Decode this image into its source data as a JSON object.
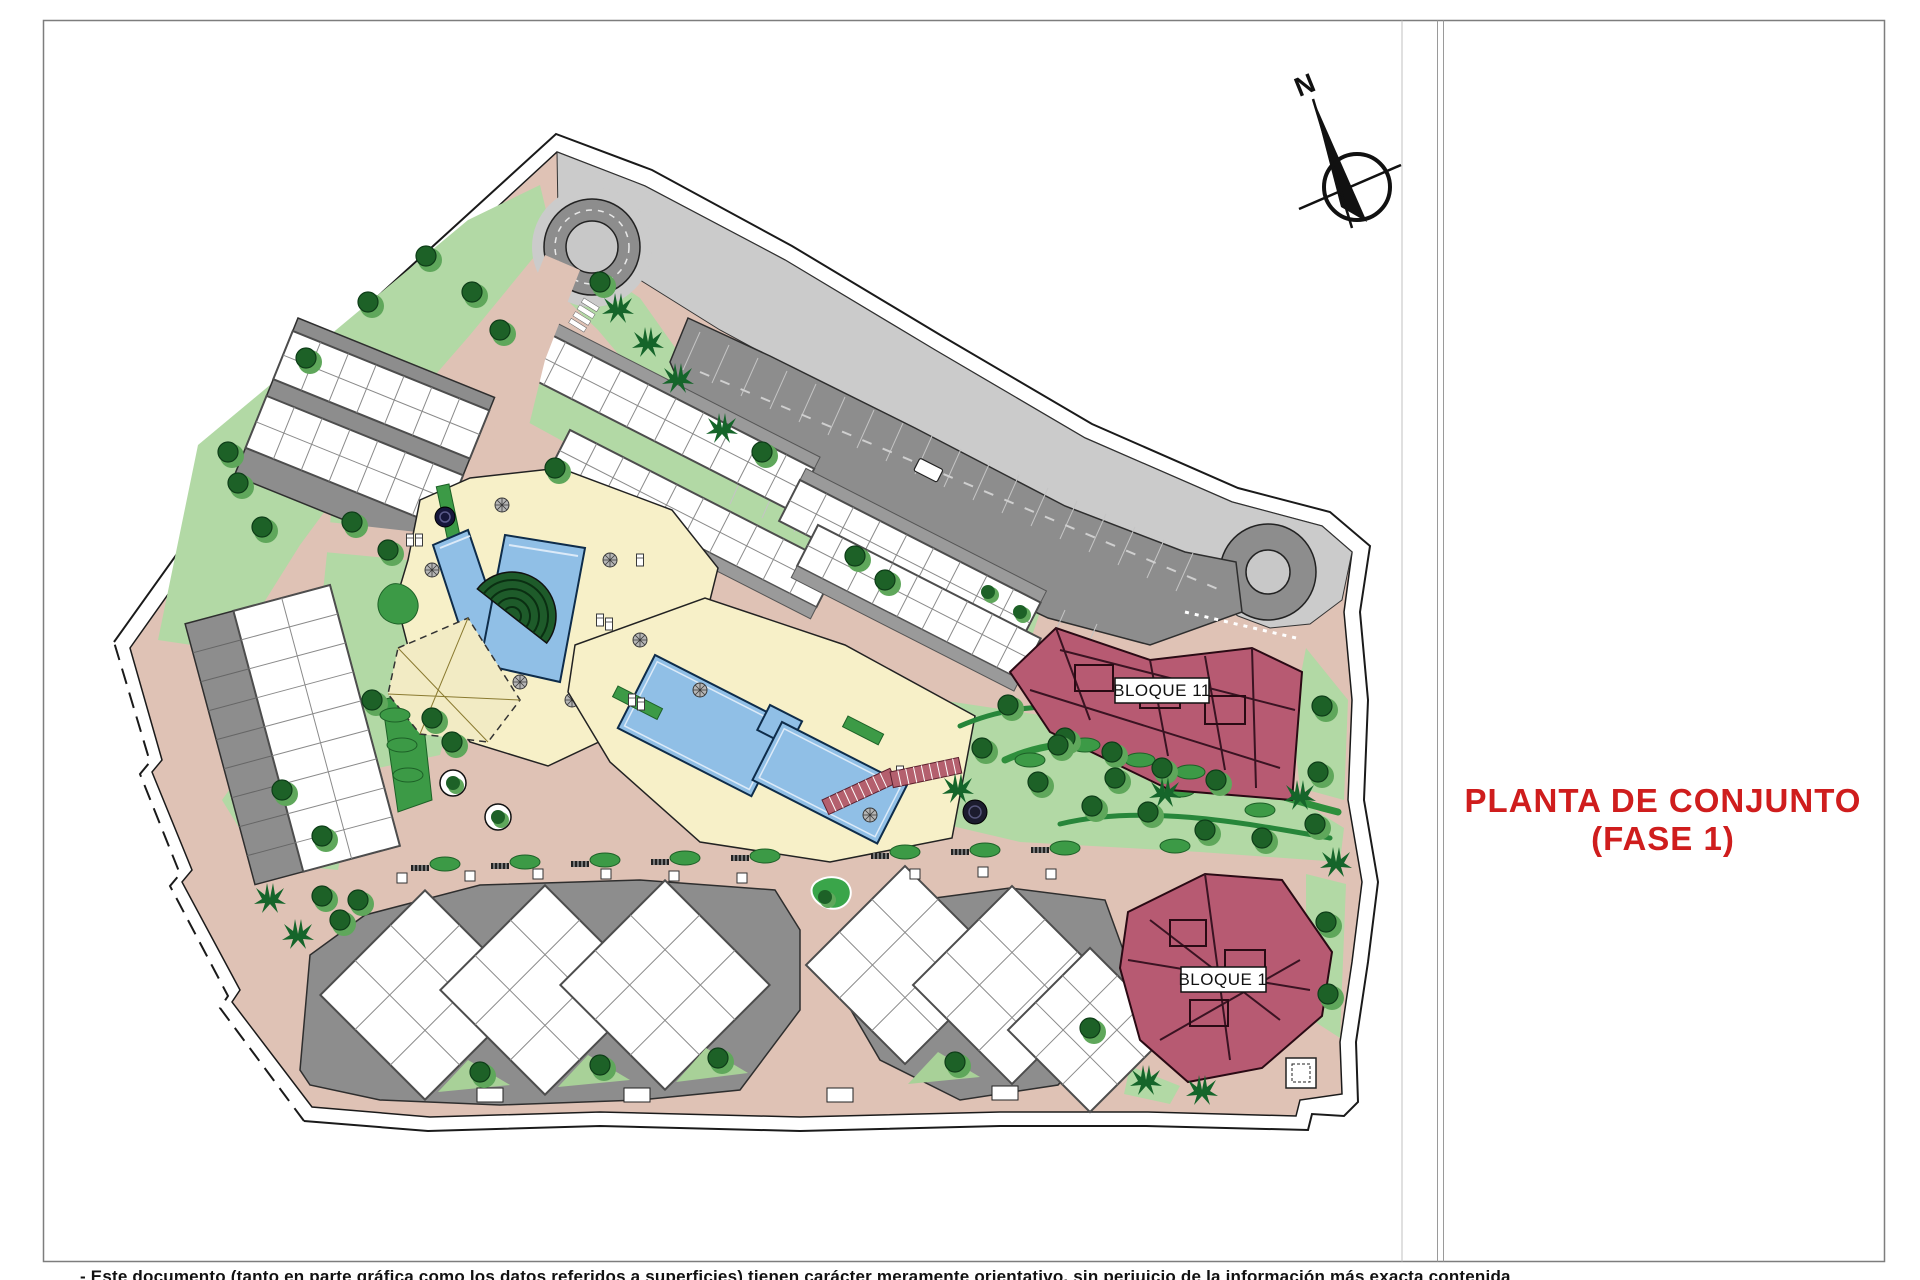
{
  "sheet": {
    "title": {
      "line1": "PLANTA DE CONJUNTO",
      "line2": "(FASE 1)"
    }
  },
  "compass": {
    "north": "N"
  },
  "plan": {
    "building_labels": {
      "bloque11": "BLOQUE 11",
      "bloque1": "BLOQUE 1"
    }
  },
  "footer": {
    "disclaimer": "- Este documento (tanto en parte gráfica como los datos referidos a superficies) tienen carácter meramente orientativo, sin perjuicio de la información más exacta contenida"
  },
  "palette": {
    "title_red": "#cf1d1d",
    "building_maroon": "#b75a72",
    "path_pink": "#dfc2b5",
    "lawn_green": "#b2d9a5",
    "tree_green": "#1d6127",
    "pool_blue": "#90bfe6",
    "deck_cream": "#f7f0c8",
    "parking_gray": "#8d8d8d",
    "road_gray": "#cbcbcb"
  }
}
